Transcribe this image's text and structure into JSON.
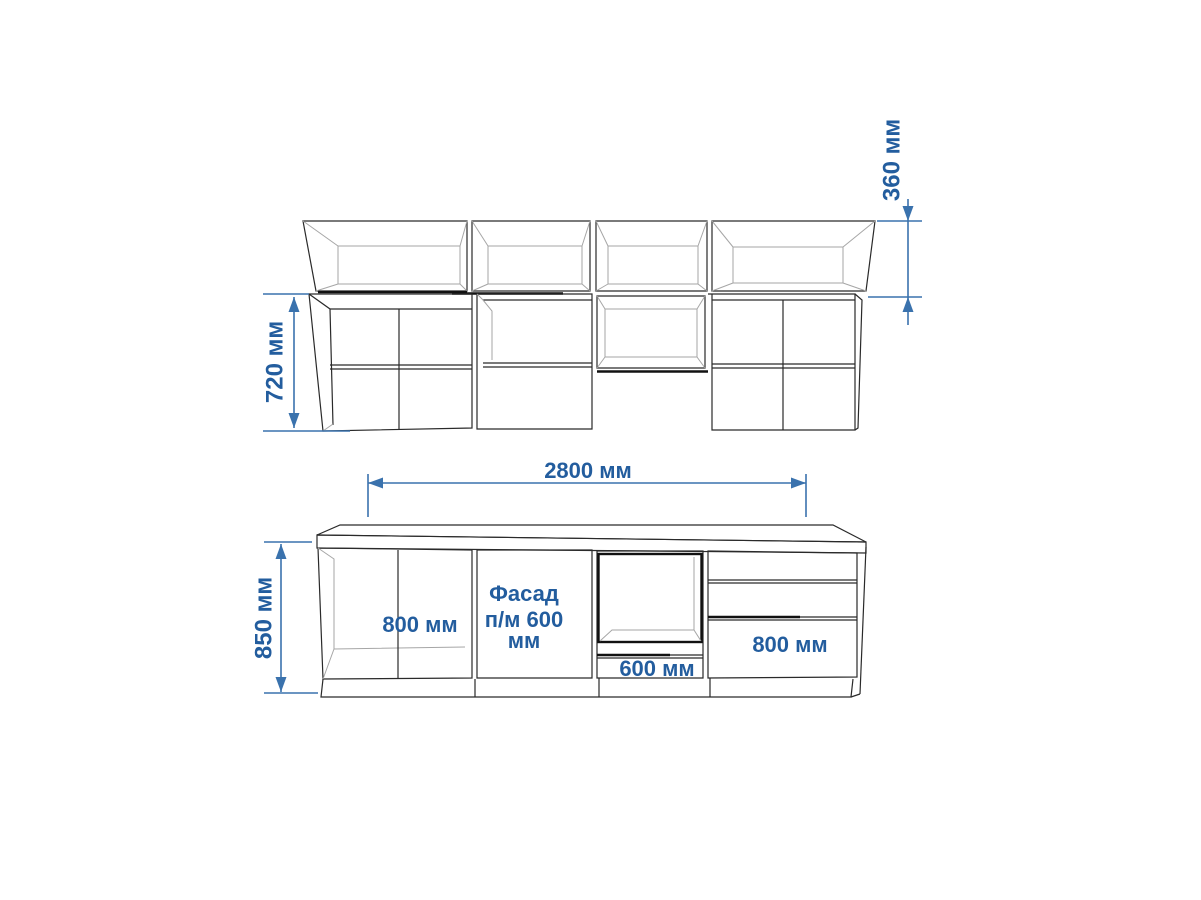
{
  "diagram": {
    "title_semantic": "kitchen cabinet set dimension drawing",
    "upper_view": {
      "top_box_height_dim": "360 мм",
      "cabinet_height_dim": "720 мм"
    },
    "lower_view": {
      "total_width_dim": "2800 мм",
      "total_height_dim": "850 мм",
      "section_1_label": "800 мм",
      "section_2_label_line1": "Фасад",
      "section_2_label_line2": "п/м 600",
      "section_2_label_line3": "мм",
      "section_3_label": "600 мм",
      "section_4_label": "800 мм"
    },
    "colors": {
      "line_art": "#2a2a2a",
      "line_art_light": "#a6a6a6",
      "line_art_bold": "#111111",
      "dimension_line": "#3a72ad",
      "dimension_text": "#235d9e",
      "page_bg": "#ffffff"
    }
  }
}
